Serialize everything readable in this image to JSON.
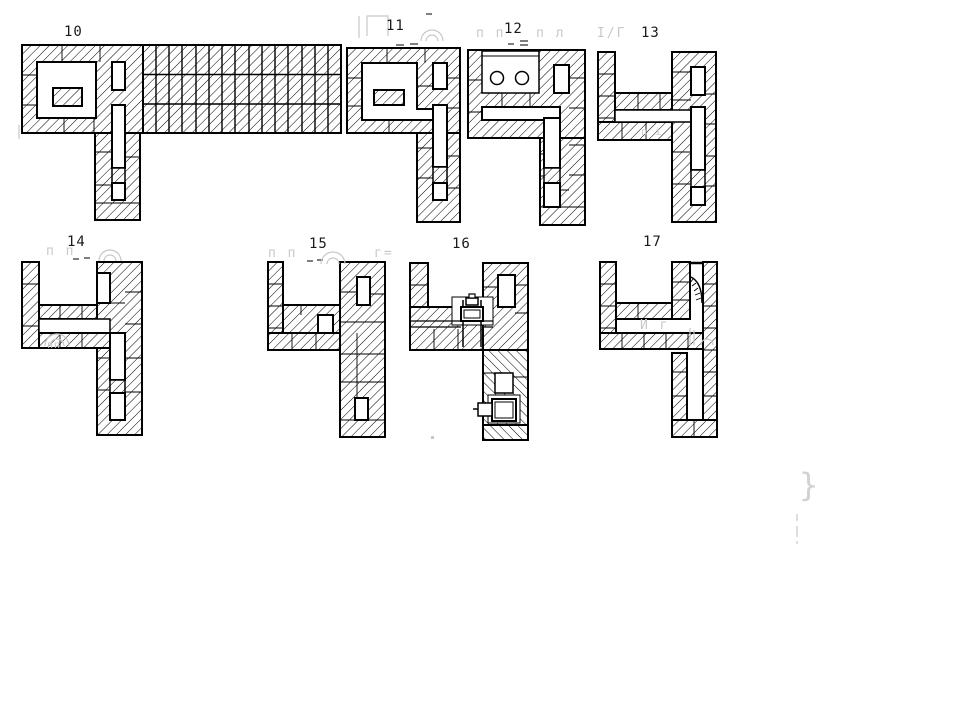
{
  "page": {
    "background": "#ffffff",
    "ink": "#000000",
    "ghost_color": "#c8c8c8",
    "description": "Scanned technical drawing: masonry heater brick course plans"
  },
  "figures": [
    {
      "id": "course-10",
      "label": "10"
    },
    {
      "id": "course-11",
      "label": "11"
    },
    {
      "id": "course-12",
      "label": "12"
    },
    {
      "id": "course-13",
      "label": "13"
    },
    {
      "id": "course-14",
      "label": "14"
    },
    {
      "id": "course-15",
      "label": "15"
    },
    {
      "id": "course-16",
      "label": "16"
    },
    {
      "id": "course-17",
      "label": "17"
    }
  ],
  "symbols": {
    "burner_circles": "two round burner openings (figure 12)",
    "damper_upper": "slide damper symbol (figure 16)",
    "damper_lower": "slide damper symbol lower (figure 16)",
    "flue_arc": "damper blade arc (figure 17)"
  },
  "ghosts": {
    "pi_pair_a": "п п",
    "pi_lambda": "п л",
    "slash_13": "І/Г",
    "pi_pair_14": "п п",
    "pi_pair_15": "п п",
    "gamma_15": "г=",
    "letters_17": "И г",
    "pi_13": "п і",
    "court_14": "пп",
    "brace": "}"
  }
}
